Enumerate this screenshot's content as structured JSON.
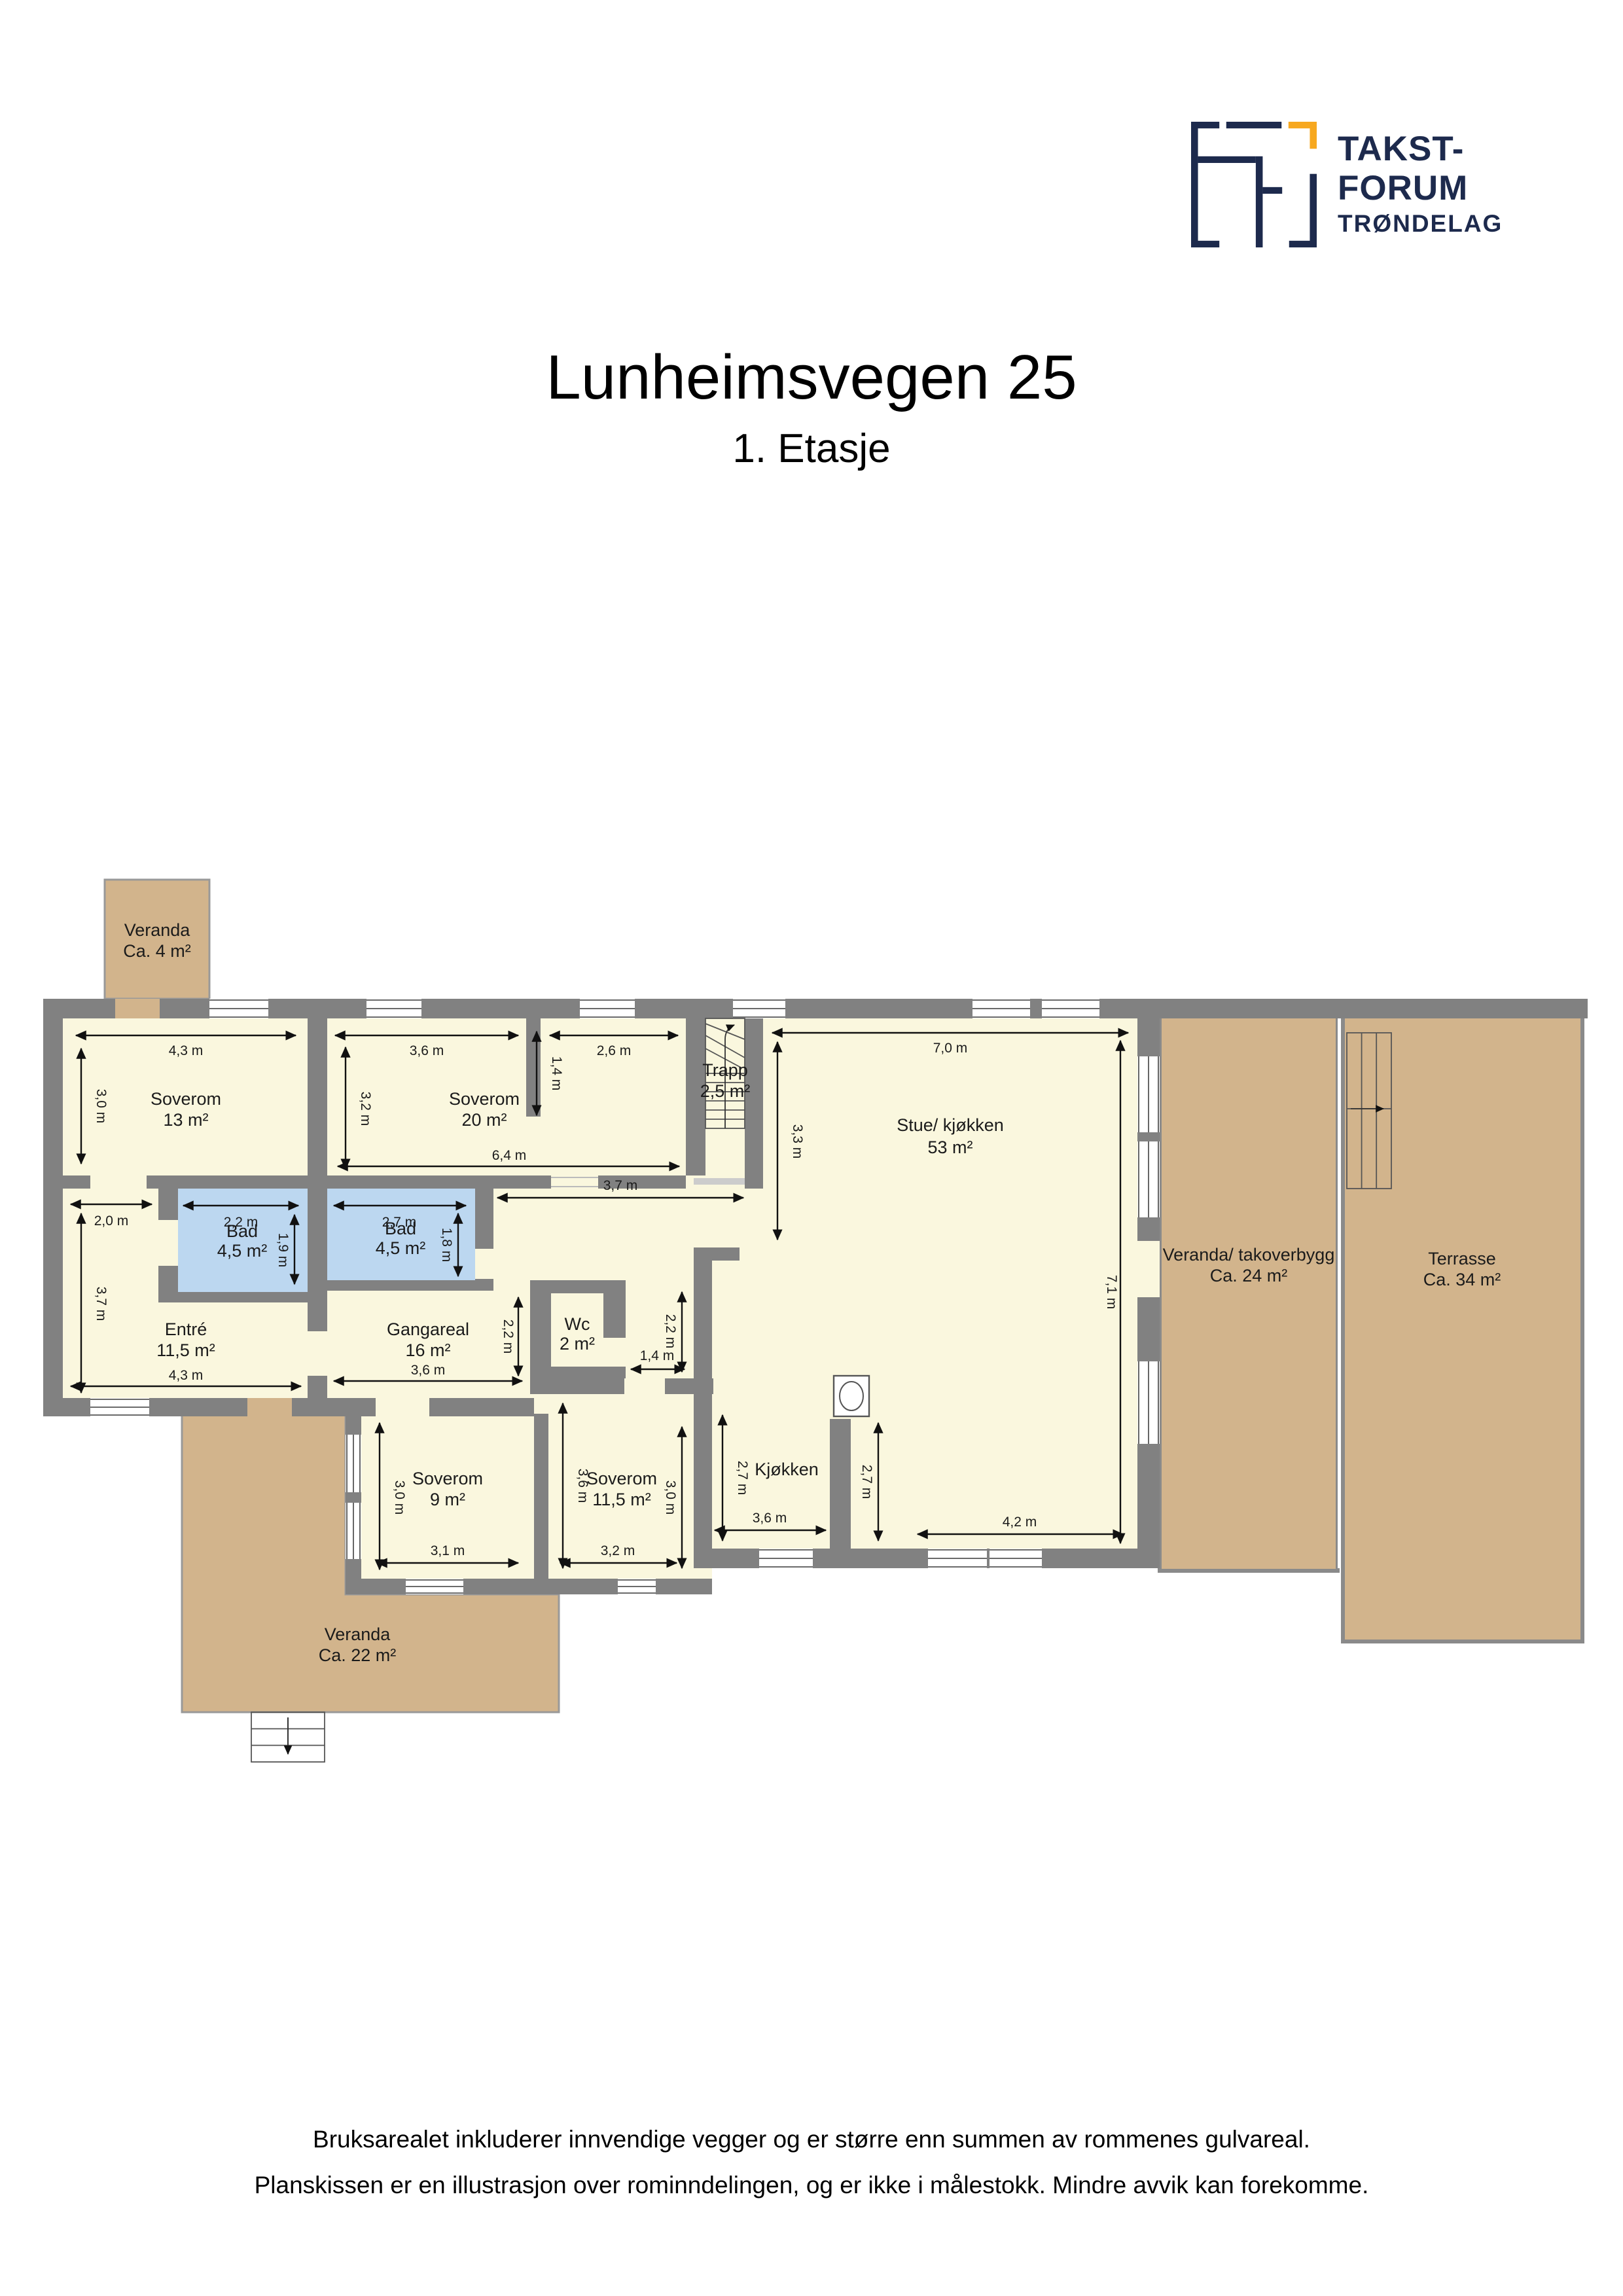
{
  "logo": {
    "line1": "TAKST-",
    "line2": "FORUM",
    "line3": "TRØNDELAG"
  },
  "title": "Lunheimsvegen 25",
  "subtitle": "1. Etasje",
  "footer": {
    "line1": "Bruksarealet inkluderer innvendige vegger og er større enn summen av rommenes gulvareal.",
    "line2": "Planskissen er en illustrasjon over rominndelingen, og er ikke i målestokk. Mindre avvik kan forekomme."
  },
  "colors": {
    "floor_cream": "#FAF7DE",
    "outdoor_tan": "#D2B48C",
    "bathroom_blue": "#BCD7F0",
    "wall_gray": "#818181",
    "logo_navy": "#1D2A4D",
    "logo_orange": "#F7A81F"
  },
  "plan": {
    "rooms": [
      {
        "name": "Veranda",
        "area": "Ca. 4 m²"
      },
      {
        "name": "Soverom",
        "area": "13 m²"
      },
      {
        "name": "Soverom",
        "area": "20 m²"
      },
      {
        "name": "Trapp",
        "area": "2,5 m²"
      },
      {
        "name": "Stue/ kjøkken",
        "area": "53 m²"
      },
      {
        "name": "Veranda/ takoverbygg",
        "area": "Ca. 24 m²"
      },
      {
        "name": "Terrasse",
        "area": "Ca. 34 m²"
      },
      {
        "name": "Bad",
        "area": "4,5 m²"
      },
      {
        "name": "Bad",
        "area": "4,5 m²"
      },
      {
        "name": "Entré",
        "area": "11,5 m²"
      },
      {
        "name": "Gangareal",
        "area": "16 m²"
      },
      {
        "name": "Wc",
        "area": "2 m²"
      },
      {
        "name": "Kjøkken"
      },
      {
        "name": "Soverom",
        "area": "9 m²"
      },
      {
        "name": "Soverom",
        "area": "11,5 m²"
      },
      {
        "name": "Veranda",
        "area": "Ca. 22 m²"
      }
    ],
    "dims": [
      {
        "label": "4,3 m"
      },
      {
        "label": "3,0 m"
      },
      {
        "label": "3,6 m"
      },
      {
        "label": "2,6 m"
      },
      {
        "label": "1,4 m"
      },
      {
        "label": "3,2 m"
      },
      {
        "label": "6,4 m"
      },
      {
        "label": "7,0 m"
      },
      {
        "label": "3,3 m"
      },
      {
        "label": "7,1 m"
      },
      {
        "label": "2,0 m"
      },
      {
        "label": "3,7 m"
      },
      {
        "label": "4,3 m"
      },
      {
        "label": "2,2 m"
      },
      {
        "label": "1,9 m"
      },
      {
        "label": "2,7 m"
      },
      {
        "label": "1,8 m"
      },
      {
        "label": "3,7 m"
      },
      {
        "label": "2,2 m"
      },
      {
        "label": "3,6 m"
      },
      {
        "label": "2,2 m"
      },
      {
        "label": "1,4 m"
      },
      {
        "label": "2,7 m"
      },
      {
        "label": "3,6 m"
      },
      {
        "label": "2,7 m"
      },
      {
        "label": "4,2 m"
      },
      {
        "label": "3,0 m"
      },
      {
        "label": "3,1 m"
      },
      {
        "label": "3,6 m"
      },
      {
        "label": "3,0 m"
      },
      {
        "label": "3,2 m"
      }
    ]
  }
}
